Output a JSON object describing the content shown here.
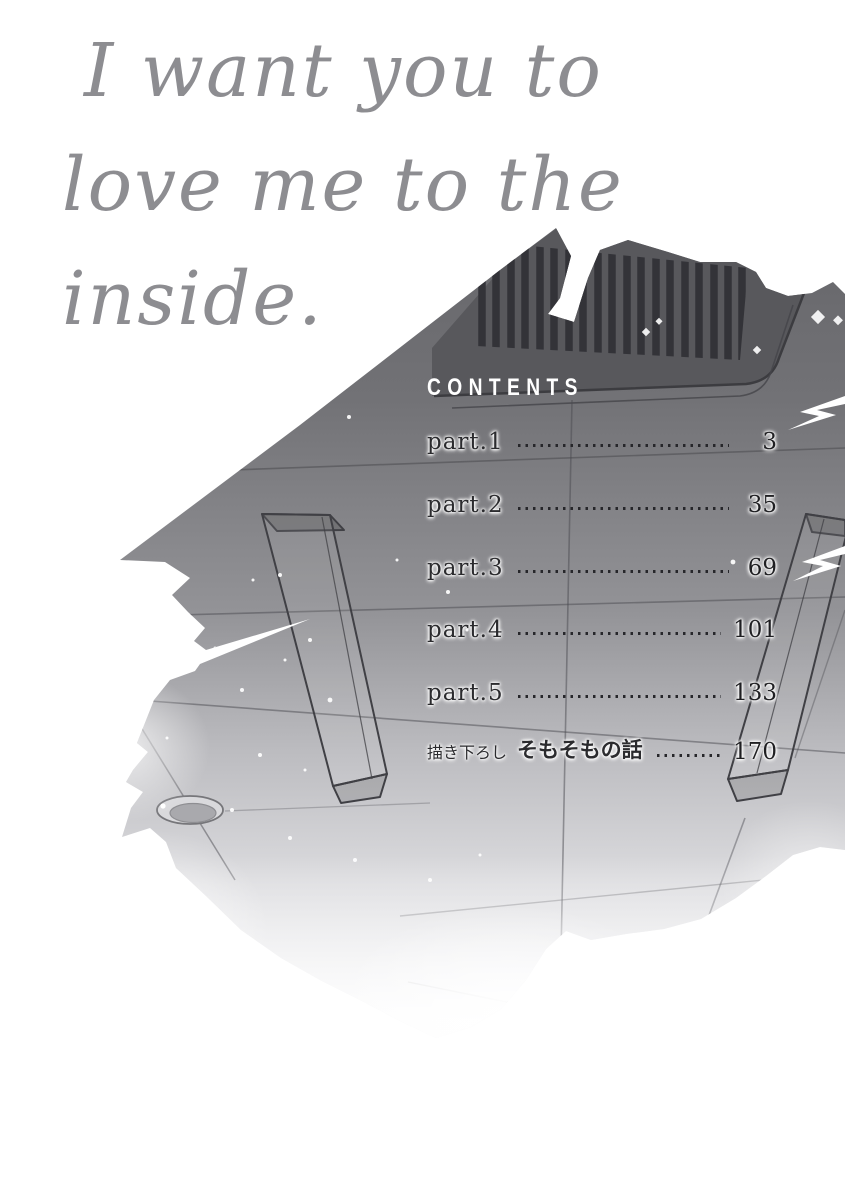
{
  "book": {
    "title_lines": [
      "I want you to",
      "love me to the",
      "inside."
    ],
    "contents_heading": "CONTENTS",
    "toc": [
      {
        "prefix": "",
        "label": "part.1",
        "page": "3"
      },
      {
        "prefix": "",
        "label": "part.2",
        "page": "35"
      },
      {
        "prefix": "",
        "label": "part.3",
        "page": "69"
      },
      {
        "prefix": "",
        "label": "part.4",
        "page": "101"
      },
      {
        "prefix": "",
        "label": "part.5",
        "page": "133"
      },
      {
        "prefix": "描き下ろし",
        "label": "そもそもの話",
        "page": "170"
      }
    ],
    "illustration": {
      "description_items": [
        "ceiling-seen-from-below",
        "air-vent-grille",
        "two-hanging-beams",
        "recessed-round-light",
        "torn-paper-edges",
        "sparkle-dots"
      ]
    },
    "colors": {
      "background": "#ffffff",
      "title_gray": "#8d8d91",
      "contents_text": "#ffffff",
      "toc_text": "#26262a",
      "toc_page_text": "#1f1f22",
      "ceiling_dark": "#66666a",
      "ceiling_light": "#efeff1",
      "vent_panel": "#58585c",
      "vent_slat": "#333338",
      "outline": "#404045"
    }
  }
}
